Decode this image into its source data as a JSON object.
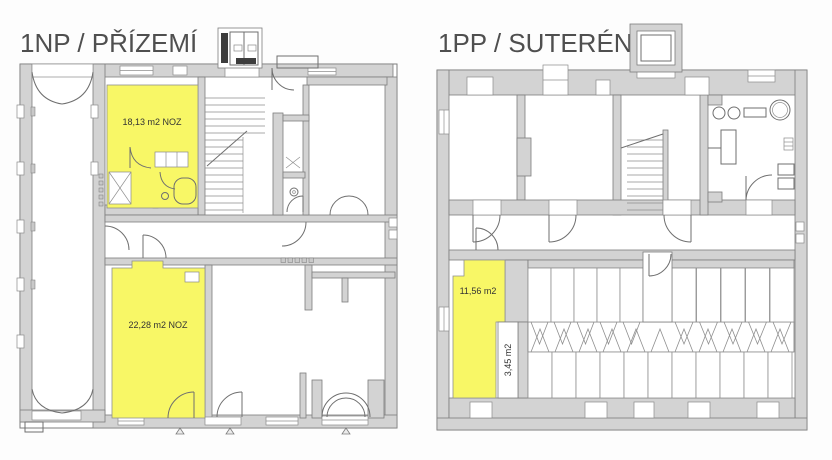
{
  "canvas": {
    "background": "#fdfdfd"
  },
  "colors": {
    "highlight_yellow": "#f8f766",
    "wall_fill": "#d3d3d3",
    "wall_stroke": "#7d7d7d",
    "line": "#6f6f6f",
    "dark_detail": "#3d3d3d",
    "title_text": "#4f4f4f",
    "label_text": "#333333"
  },
  "plans": {
    "ground": {
      "title": "1NP / PŘÍZEMÍ",
      "rooms": [
        {
          "name": "room-18",
          "label": "18,13 m2 NOZ"
        },
        {
          "name": "room-22",
          "label": "22,28 m2 NOZ"
        }
      ]
    },
    "basement": {
      "title": "1PP / SUTERÉN",
      "rooms": [
        {
          "name": "room-11",
          "label": "11,56 m2"
        },
        {
          "name": "room-3",
          "label": "3,45 m2"
        }
      ]
    }
  }
}
